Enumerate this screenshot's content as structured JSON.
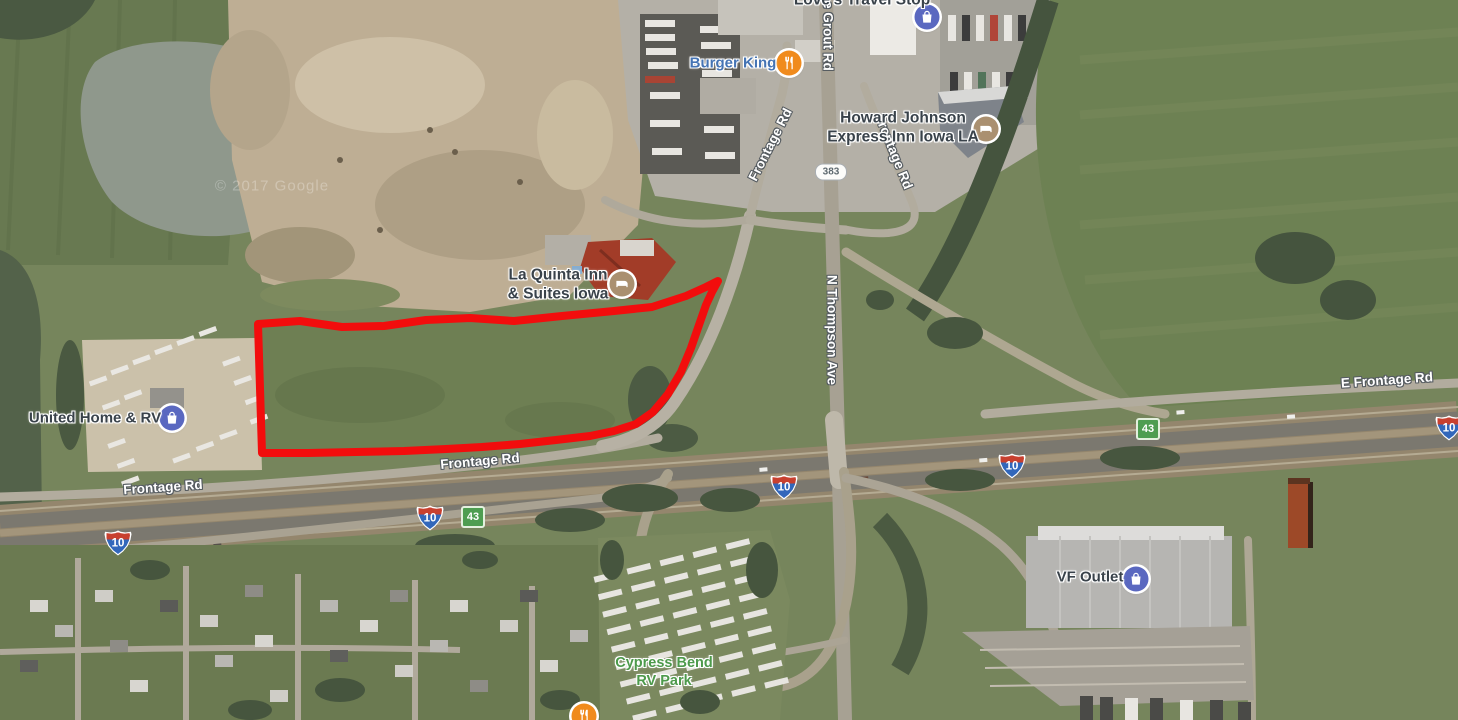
{
  "map": {
    "watermark": "© 2017 Google",
    "parcel": {
      "outline_color": "#f20d0d"
    },
    "shields": {
      "interstate_10": "10",
      "state_43": "43",
      "state_383": "383"
    },
    "roads": {
      "frontage_rd": "Frontage Rd",
      "e_frontage_rd": "E Frontage Rd",
      "n_thompson_ave": "N Thompson Ave",
      "grout_rd": "e Grout Rd"
    },
    "poi": {
      "loves": "Love's Travel Stop",
      "burger_king": "Burger King",
      "howard_johnson_line1": "Howard Johnson",
      "howard_johnson_line2": "Express Inn Iowa LA",
      "la_quinta_line1": "La Quinta Inn",
      "la_quinta_line2": "& Suites Iowa",
      "united_home_rv": "United Home & RV",
      "vf_outlet": "VF Outlet",
      "cypress_bend_line1": "Cypress Bend",
      "cypress_bend_line2": "RV Park"
    },
    "icon_colors": {
      "shopping": "#5a68c0",
      "lodging": "#aa9070",
      "food": "#f08b1d"
    }
  }
}
